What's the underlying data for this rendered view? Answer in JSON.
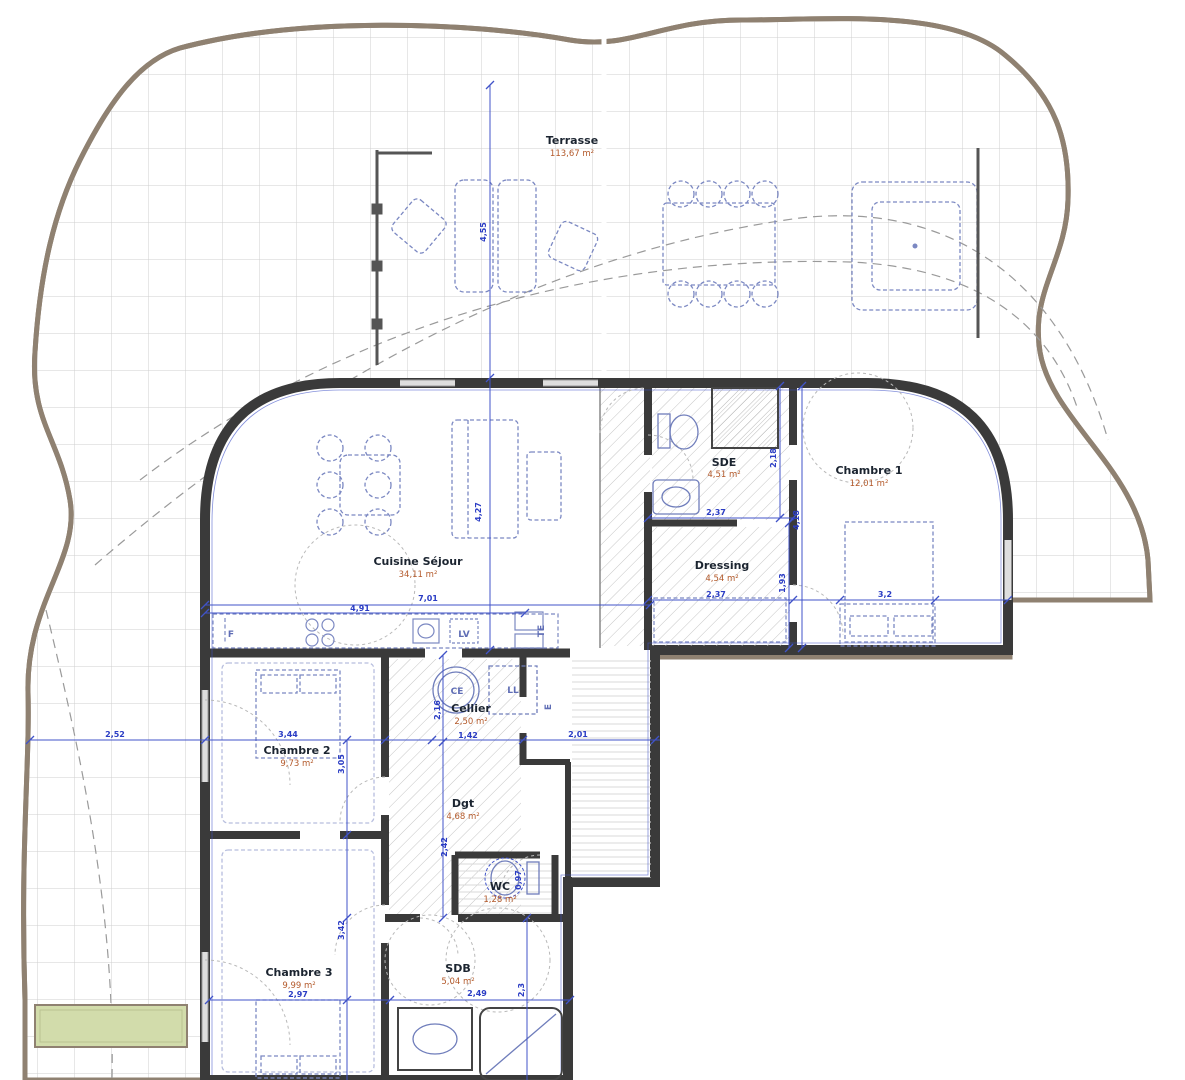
{
  "plan_type": "apartment-floor-plan-with-terrace",
  "rooms": [
    {
      "name": "Terrasse",
      "area": "113,67 m²"
    },
    {
      "name": "Cuisine Séjour",
      "area": "34,11 m²"
    },
    {
      "name": "SDE",
      "area": "4,51 m²"
    },
    {
      "name": "Chambre 1",
      "area": "12,01 m²"
    },
    {
      "name": "Dressing",
      "area": "4,54 m²"
    },
    {
      "name": "Cellier",
      "area": "2,50 m²"
    },
    {
      "name": "Chambre 2",
      "area": "9,73 m²"
    },
    {
      "name": "Dgt",
      "area": "4,68 m²"
    },
    {
      "name": "WC",
      "area": "1,28 m²"
    },
    {
      "name": "Chambre 3",
      "area": "9,99 m²"
    },
    {
      "name": "SDB",
      "area": "5,04 m²"
    }
  ],
  "dims": [
    "4,55",
    "7,01",
    "4,91",
    "4,27",
    "2,37",
    "2,18",
    "2,37",
    "1,93",
    "4,18",
    "3,2",
    "3,44",
    "2,52",
    "3,05",
    "1,42",
    "2,01",
    "2,16",
    "2,42",
    "3,42",
    "0,97",
    "2,97",
    "2,49",
    "2,3"
  ],
  "appliances": [
    "F",
    "LV",
    "TE",
    "CE",
    "LL",
    "E"
  ],
  "colors": {
    "wall": "#3a3a3a",
    "dimension_blue": "#3b4ec8",
    "area_orange": "#b3592a",
    "boundary_tan": "#8f8171",
    "tile_grid": "#cfcfcf",
    "planter_green": "#d2dcab",
    "furniture_blue": "#7b88c2"
  }
}
